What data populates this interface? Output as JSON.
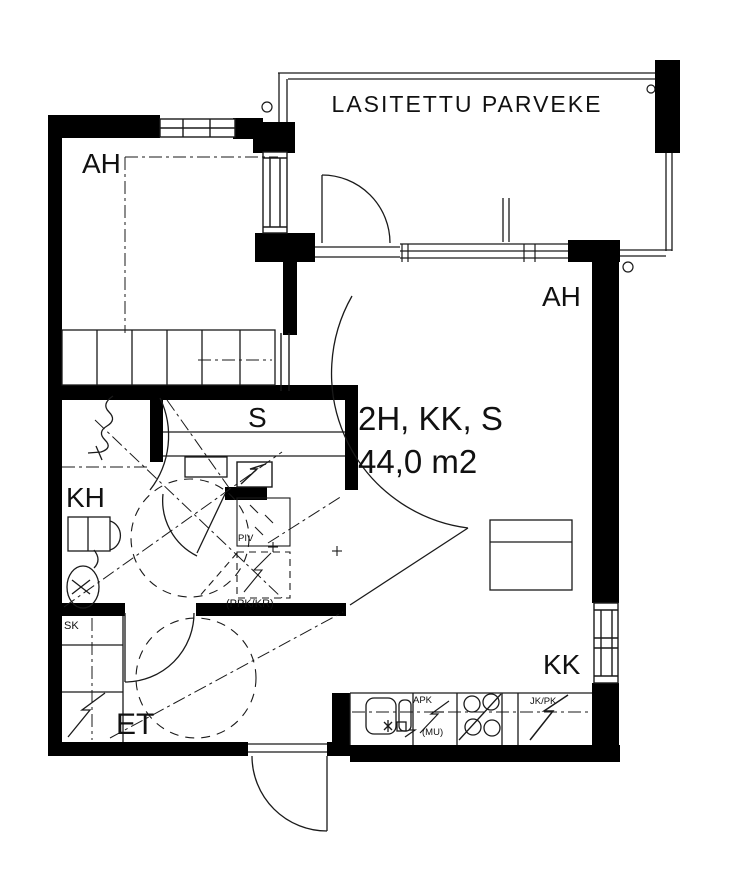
{
  "plan": {
    "balcony_label": "LASITETTU PARVEKE",
    "title": "2H, KK, S",
    "area": "44,0 m2",
    "rooms": {
      "bedroom": "AH",
      "living": "AH",
      "sauna": "S",
      "bathroom": "KH",
      "hallway": "ET",
      "kitchenette": "KK"
    },
    "annotations": {
      "cleaning_closet": "SK",
      "washer_dryer_reservation": "(PPK/KR)",
      "piv_label": "PIV",
      "dishwasher": "APK",
      "dishwasher_note": "(MU)",
      "fridge_freezer": "JK/PK"
    },
    "colors": {
      "wall": "#000000",
      "line": "#1a1a1a",
      "background": "#ffffff"
    }
  }
}
